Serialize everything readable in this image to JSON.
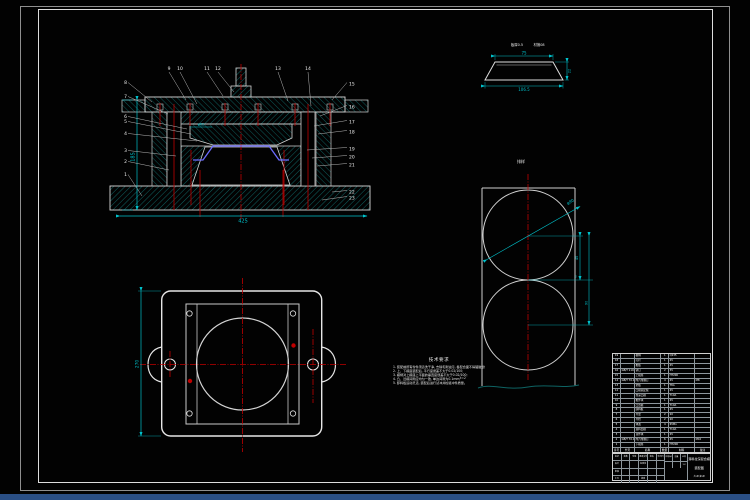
{
  "section_view": {
    "callouts_left": [
      "8",
      "7",
      "6",
      "5",
      "4",
      "3",
      "2",
      "1"
    ],
    "callouts_top": [
      "9",
      "10",
      "11",
      "12",
      "13",
      "14"
    ],
    "callouts_right": [
      "15",
      "16",
      "17",
      "18",
      "19",
      "20",
      "21",
      "22",
      "23"
    ],
    "dims": {
      "overall_height": "185",
      "overall_width": "425",
      "cavity_dia": "φ62"
    }
  },
  "part_view": {
    "labels": {
      "l1": "板厚0.5",
      "l2": "材攁08"
    },
    "dims": {
      "top": "75",
      "bottom": "106.5",
      "height": "22"
    }
  },
  "strip_view": {
    "title": "排样",
    "dims": {
      "dia": "φ90",
      "pitch": "45",
      "span": "90",
      "bridge": "2",
      "edge": "t=2"
    }
  },
  "plate_view": {
    "dims": {
      "height": "270"
    }
  },
  "notes": {
    "heading": "技术要求",
    "lines": [
      "1. 装配前所有零件须清洗干净, 去除毛刺油污, 各配合面不得磕碰划伤;",
      "2. 上、下模座装配后, 平行度误差不大于0.02/100;",
      "3. 模柄对上模座上平面的垂直度误差不大于0.02/100;",
      "4. 凸、凹模间隙应均匀一致, 单边间隙为0.1mm;",
      "5. 卸料板运动灵活, 装配后进行试冲并检验冲件质量。"
    ]
  },
  "bom": {
    "headers": [
      "序号",
      "代号",
      "名称",
      "数量",
      "材料",
      "备注"
    ],
    "rows": [
      {
        "no": "19",
        "code": "",
        "name": "模柄",
        "qty": "1",
        "mat": "Q235",
        "note": ""
      },
      {
        "no": "18",
        "code": "",
        "name": "打杆",
        "qty": "1",
        "mat": "45",
        "note": ""
      },
      {
        "no": "17",
        "code": "",
        "name": "推板",
        "qty": "1",
        "mat": "45",
        "note": ""
      },
      {
        "no": "16",
        "code": "GB/T 119.1",
        "name": "销钉",
        "qty": "2",
        "mat": "35",
        "note": ""
      },
      {
        "no": "15",
        "code": "",
        "name": "上模座",
        "qty": "1",
        "mat": "HT200",
        "note": ""
      },
      {
        "no": "14",
        "code": "GB/T 70.1",
        "name": "内六角螺钉",
        "qty": "4",
        "mat": "45",
        "note": "M8"
      },
      {
        "no": "13",
        "code": "",
        "name": "垫板",
        "qty": "1",
        "mat": "T8A",
        "note": ""
      },
      {
        "no": "12",
        "code": "",
        "name": "凸模固定板",
        "qty": "1",
        "mat": "45",
        "note": ""
      },
      {
        "no": "11",
        "code": "",
        "name": "拉深凸模",
        "qty": "1",
        "mat": "T10A",
        "note": ""
      },
      {
        "no": "10",
        "code": "",
        "name": "推件块",
        "qty": "1",
        "mat": "45",
        "note": ""
      },
      {
        "no": "9",
        "code": "",
        "name": "凸凹模",
        "qty": "1",
        "mat": "T10A",
        "note": ""
      },
      {
        "no": "8",
        "code": "",
        "name": "卸料板",
        "qty": "1",
        "mat": "45",
        "note": ""
      },
      {
        "no": "7",
        "code": "",
        "name": "导套",
        "qty": "2",
        "mat": "20",
        "note": ""
      },
      {
        "no": "6",
        "code": "",
        "name": "导柱",
        "qty": "2",
        "mat": "20",
        "note": ""
      },
      {
        "no": "5",
        "code": "",
        "name": "弹簧",
        "qty": "4",
        "mat": "65Mn",
        "note": ""
      },
      {
        "no": "4",
        "code": "",
        "name": "落料凹模",
        "qty": "1",
        "mat": "T10A",
        "note": ""
      },
      {
        "no": "3",
        "code": "",
        "name": "顶件块",
        "qty": "1",
        "mat": "45",
        "note": ""
      },
      {
        "no": "2",
        "code": "GB/T 70.1",
        "name": "内六角螺钉",
        "qty": "6",
        "mat": "45",
        "note": "M10"
      },
      {
        "no": "1",
        "code": "",
        "name": "下模座",
        "qty": "1",
        "mat": "HT200",
        "note": ""
      }
    ]
  },
  "titleblock": {
    "row1": [
      "标记",
      "处数",
      "分区",
      "更改文件号",
      "签名",
      "年月日"
    ],
    "design": "设计",
    "standard": "标准化",
    "audit": "审核",
    "craft": "工艺",
    "approve": "批准",
    "stage_labels": [
      "阶段标记",
      "重量",
      "比例"
    ],
    "scale": "1:2",
    "title_line1": "落料拉深复合模",
    "title_line2": "装配图",
    "sheet": "共1张 第1张"
  }
}
